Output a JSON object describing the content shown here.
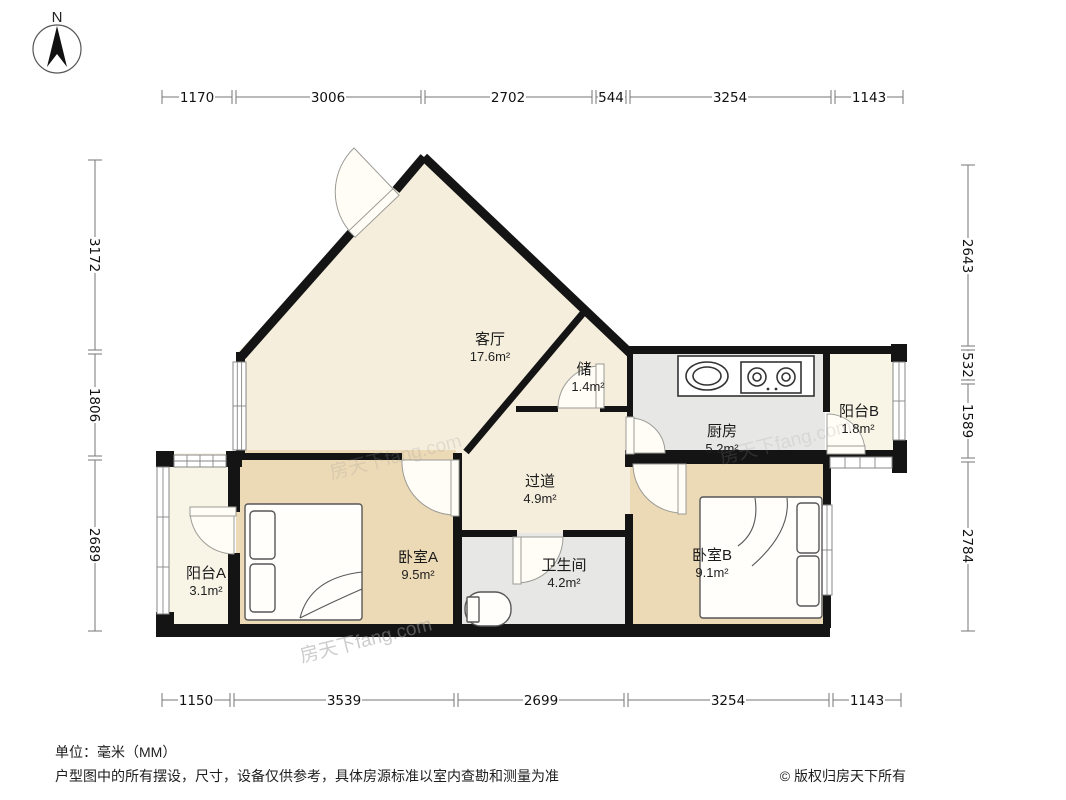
{
  "compass": {
    "north_label": "N"
  },
  "rooms": {
    "living": {
      "name": "客厅",
      "area": "17.6m²"
    },
    "storage": {
      "name": "储",
      "area": "1.4m²"
    },
    "kitchen": {
      "name": "厨房",
      "area": "5.2m²"
    },
    "balcony_b": {
      "name": "阳台B",
      "area": "1.8m²"
    },
    "hallway": {
      "name": "过道",
      "area": "4.9m²"
    },
    "bedroom_a": {
      "name": "卧室A",
      "area": "9.5m²"
    },
    "bathroom": {
      "name": "卫生间",
      "area": "4.2m²"
    },
    "bedroom_b": {
      "name": "卧室B",
      "area": "9.1m²"
    },
    "balcony_a": {
      "name": "阳台A",
      "area": "3.1m²"
    }
  },
  "dimensions": {
    "top": [
      "1170",
      "3006",
      "2702",
      "544",
      "3254",
      "1143"
    ],
    "bottom": [
      "1150",
      "3539",
      "2699",
      "3254",
      "1143"
    ],
    "left": [
      "3172",
      "1806",
      "2689"
    ],
    "right": [
      "2643",
      "532",
      "1589",
      "2784"
    ]
  },
  "footer": {
    "unit_note": "单位：毫米（MM）",
    "disclaimer": "户型图中的所有摆设，尺寸，设备仅供参考，具体房源标准以室内查勘和测量为准",
    "copyright": "© 版权归房天下所有"
  },
  "watermark": "房天下fang.com",
  "colors": {
    "wall": "#141414",
    "living_floor": "#f5eedd",
    "bedroom_floor": "#ecd9b5",
    "kitchen_floor": "#e7e7e5",
    "balcony_floor": "#f8f5e7"
  }
}
